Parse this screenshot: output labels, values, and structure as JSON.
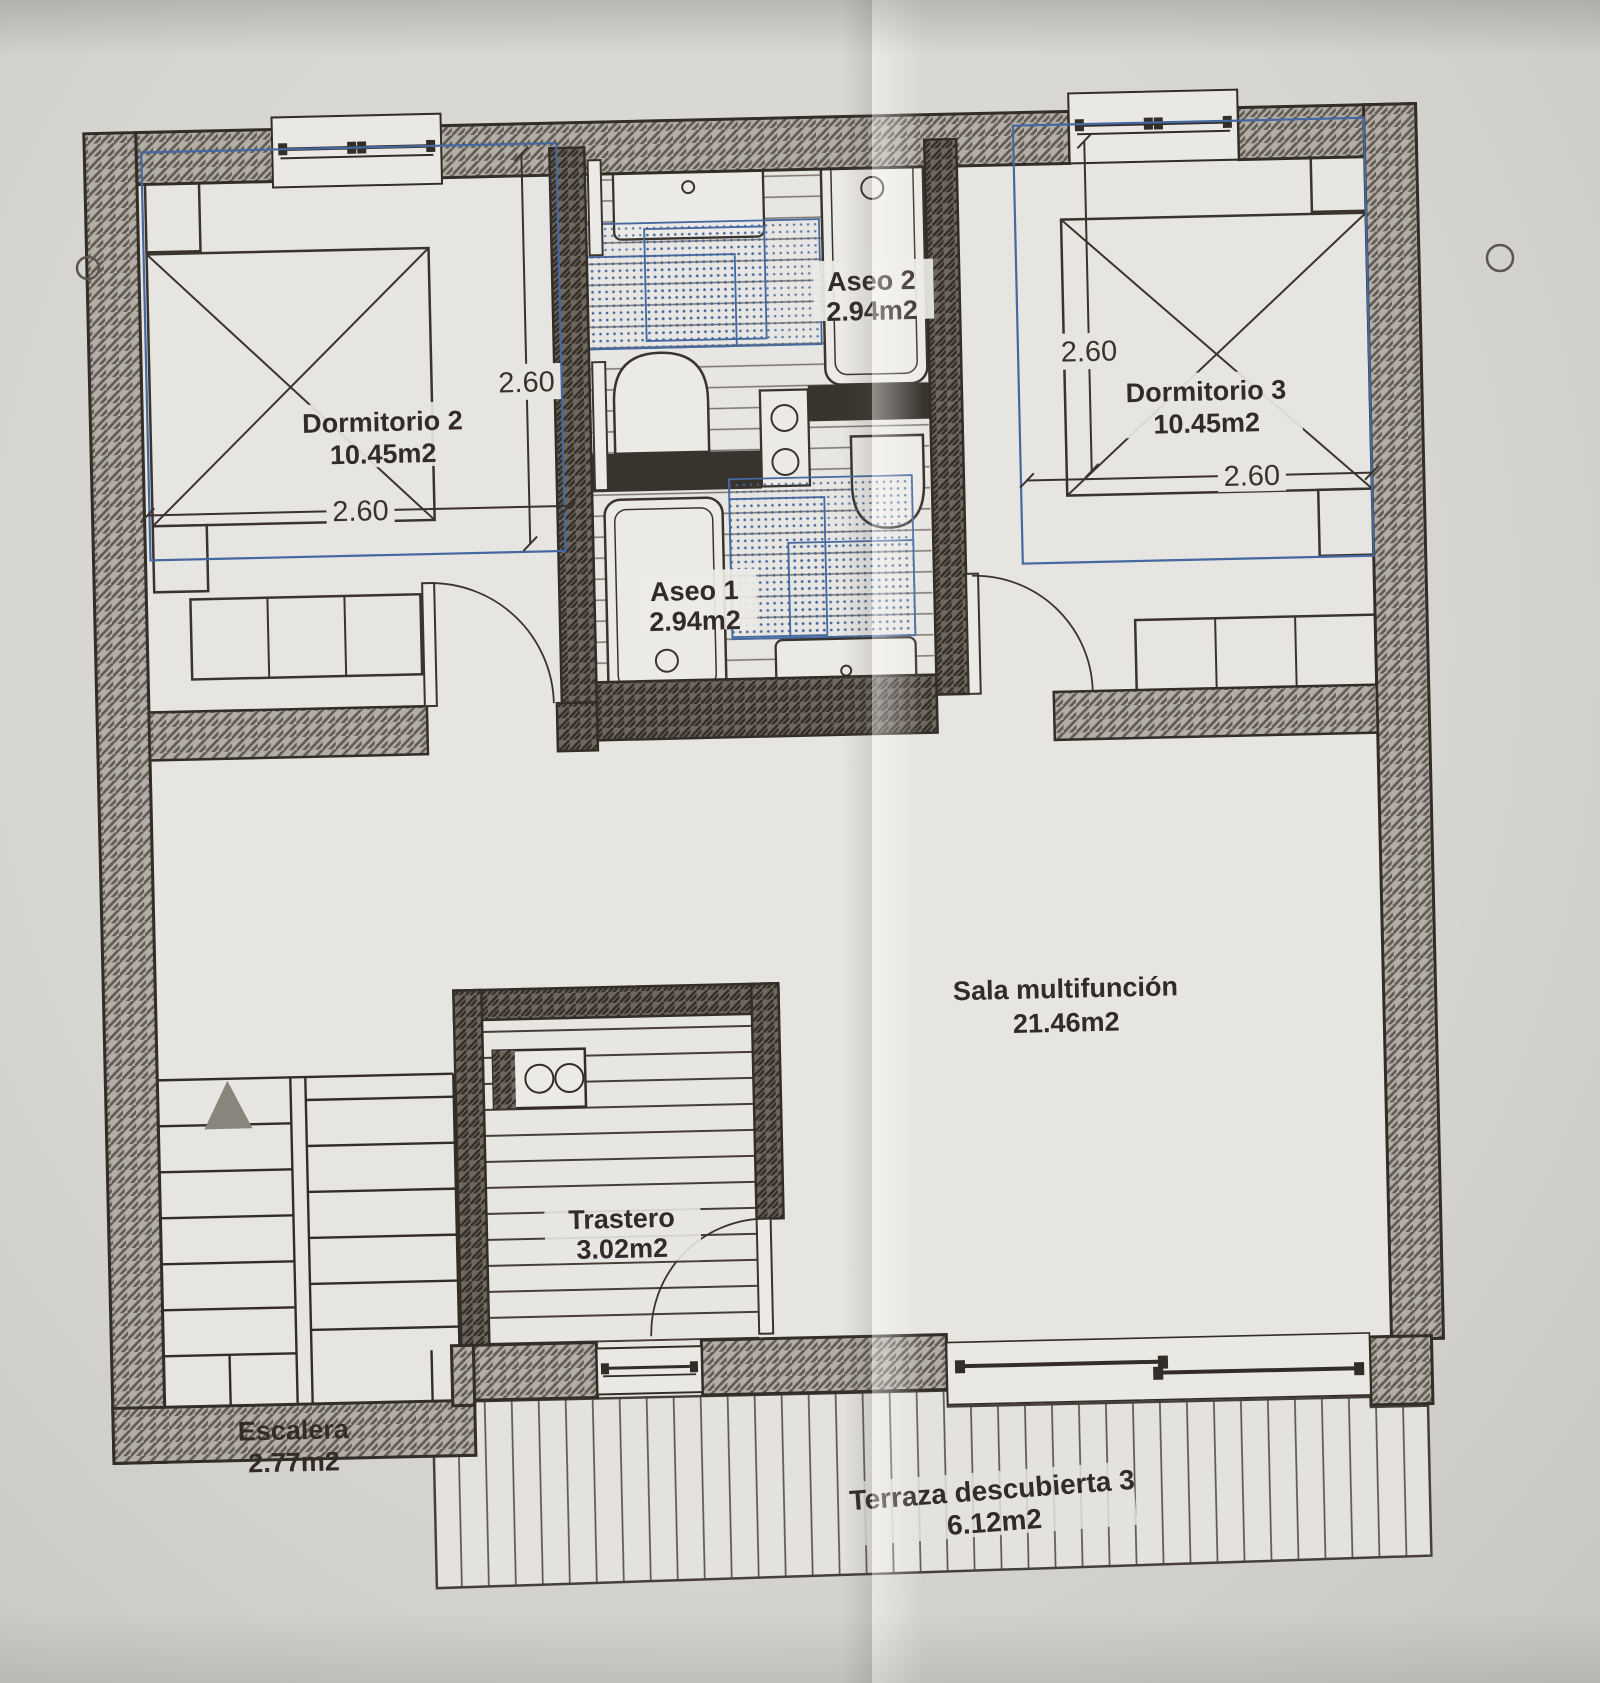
{
  "plan": {
    "rooms": [
      {
        "name": "Dormitorio 2",
        "area": "10.45m2"
      },
      {
        "name": "Aseo 2",
        "area": "2.94m2"
      },
      {
        "name": "Aseo 1",
        "area": "2.94m2"
      },
      {
        "name": "Dormitorio 3",
        "area": "10.45m2"
      },
      {
        "name": "Sala multifunción",
        "area": "21.46m2"
      },
      {
        "name": "Trastero",
        "area": "3.02m2"
      },
      {
        "name": "Escalera",
        "area": "2.77m2"
      },
      {
        "name": "Terraza descubierta 3",
        "area": "6.12m2"
      }
    ],
    "dimensions": [
      "2.60",
      "2.60",
      "2.60",
      "2.60"
    ],
    "colors": {
      "overlay_blue": "#44689f",
      "wall_line": "#332d28",
      "paper": "#d9d8d4"
    }
  }
}
